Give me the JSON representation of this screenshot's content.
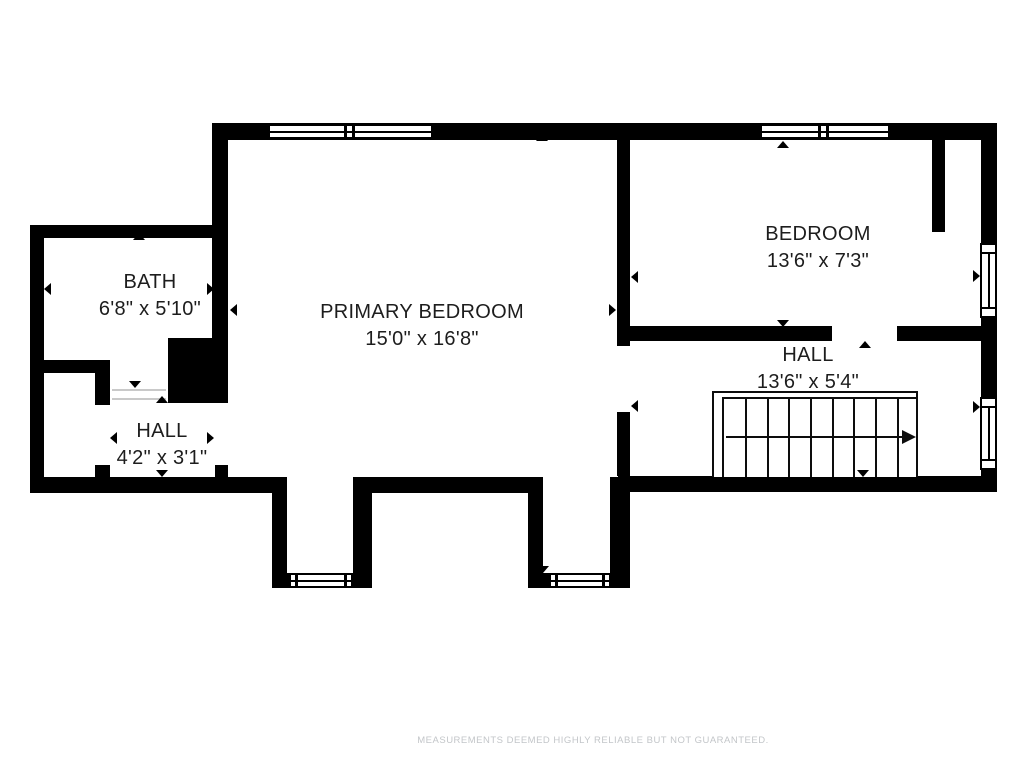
{
  "colors": {
    "wall": "#000000",
    "room_label": "#1d1d1d",
    "footer_text": "#c3c6c9",
    "background": "#ffffff"
  },
  "rooms": {
    "bath": {
      "name": "BATH",
      "dimensions": "6'8\" x 5'10\""
    },
    "primary_bedroom": {
      "name": "PRIMARY BEDROOM",
      "dimensions": "15'0\" x 16'8\""
    },
    "bedroom": {
      "name": "BEDROOM",
      "dimensions": "13'6\" x 7'3\""
    },
    "hall_upper": {
      "name": "HALL",
      "dimensions": "13'6\" x 5'4\""
    },
    "hall_lower": {
      "name": "HALL",
      "dimensions": "4'2\" x 3'1\""
    }
  },
  "footer": {
    "disclaimer": "MEASUREMENTS DEEMED HIGHLY RELIABLE BUT NOT GUARANTEED."
  }
}
